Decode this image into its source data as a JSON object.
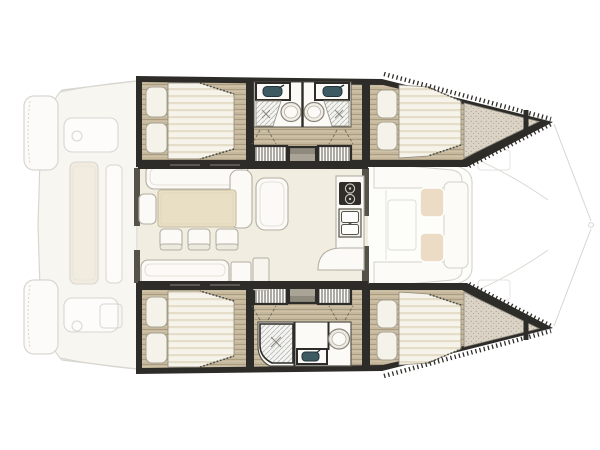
{
  "meta": {
    "title": "Catamaran interior layout floor plan",
    "type": "yacht-floor-plan",
    "orientation": "bow-right",
    "cabins": 4,
    "text_on_image": "none"
  },
  "palette": {
    "hull_wall": "#2d2c28",
    "wall_soft": "#55524a",
    "wood": "#c6b89c",
    "wood_line": "#a3957a",
    "wood_lite": "#d8cdb4",
    "floor": "#f1ede0",
    "furniture": "#fbfaf6",
    "furniture_stroke": "#b2aea2",
    "table": "#e8dfc5",
    "table_stroke": "#c9bda0",
    "mattress": "#f6f3ea",
    "mattress_stripe": "#e5ddc8",
    "pillow": "#f5f2e9",
    "pillow_stroke": "#a8a294",
    "stipple": "#dbd3c5",
    "stipple_dot": "#a89e8b",
    "sink": "#3d5a63",
    "sink_dark": "#23353b",
    "cushion": "#e9d7bc",
    "shower_line": "#b4b8b4",
    "hatch_line": "#4a4741",
    "faint": "#d2cfc8",
    "faint_fill": "#f7f5ef",
    "faint_beige": "#efe9da",
    "tread1": "#8f8a7e",
    "tread2": "#aaa497",
    "tread3": "#c4beb0",
    "tread4": "#dfdacd"
  },
  "legend": {
    "plan": "Catamaran interior layout floor plan, bow to the right",
    "exterior": "Faint exterior deck outline: stern swim platforms, aft cockpit with long table, forward cockpit lounge with two cushions, bow trampolines and forestay lines",
    "port_hull": "Port hull (top): aft double cabin, two mirrored bathrooms with sink, toilet and shower, companionway steps with slatted lockers, forward double cabin, stippled forepeak",
    "starboard_hull": "Starboard hull (bottom): aft double cabin, companionway steps with slatted lockers, bathroom with shower, sink and toilet, forward double cabin, stippled forepeak",
    "saloon": "Central saloon: L-shaped sofa, chaise seat, dining table with three chairs, side seat, aft bench, storage cabinets, galley with two-burner stove and double sink, door to forward cockpit",
    "port_aft_cabin": "Port aft double cabin",
    "port_fwd_cabin": "Port forward double cabin",
    "stbd_aft_cabin": "Starboard aft double cabin",
    "stbd_fwd_cabin": "Starboard forward double cabin",
    "galley": "Galley: two-burner stove and double sink",
    "dining": "Dining table with three chairs"
  },
  "layout_summary": {
    "hull_rooms_port": [
      "aft-cabin",
      "aft-bathroom",
      "steps",
      "forward-bathroom",
      "forward-cabin",
      "forepeak"
    ],
    "hull_rooms_starboard": [
      "aft-cabin",
      "steps",
      "shared-bathroom",
      "forward-cabin",
      "forepeak"
    ],
    "saloon_items": [
      "l-sofa",
      "chaise",
      "side-seat",
      "dining-table",
      "chair",
      "chair",
      "chair",
      "aft-bench",
      "cabinet",
      "cabinet",
      "stove",
      "double-sink",
      "counter"
    ]
  }
}
